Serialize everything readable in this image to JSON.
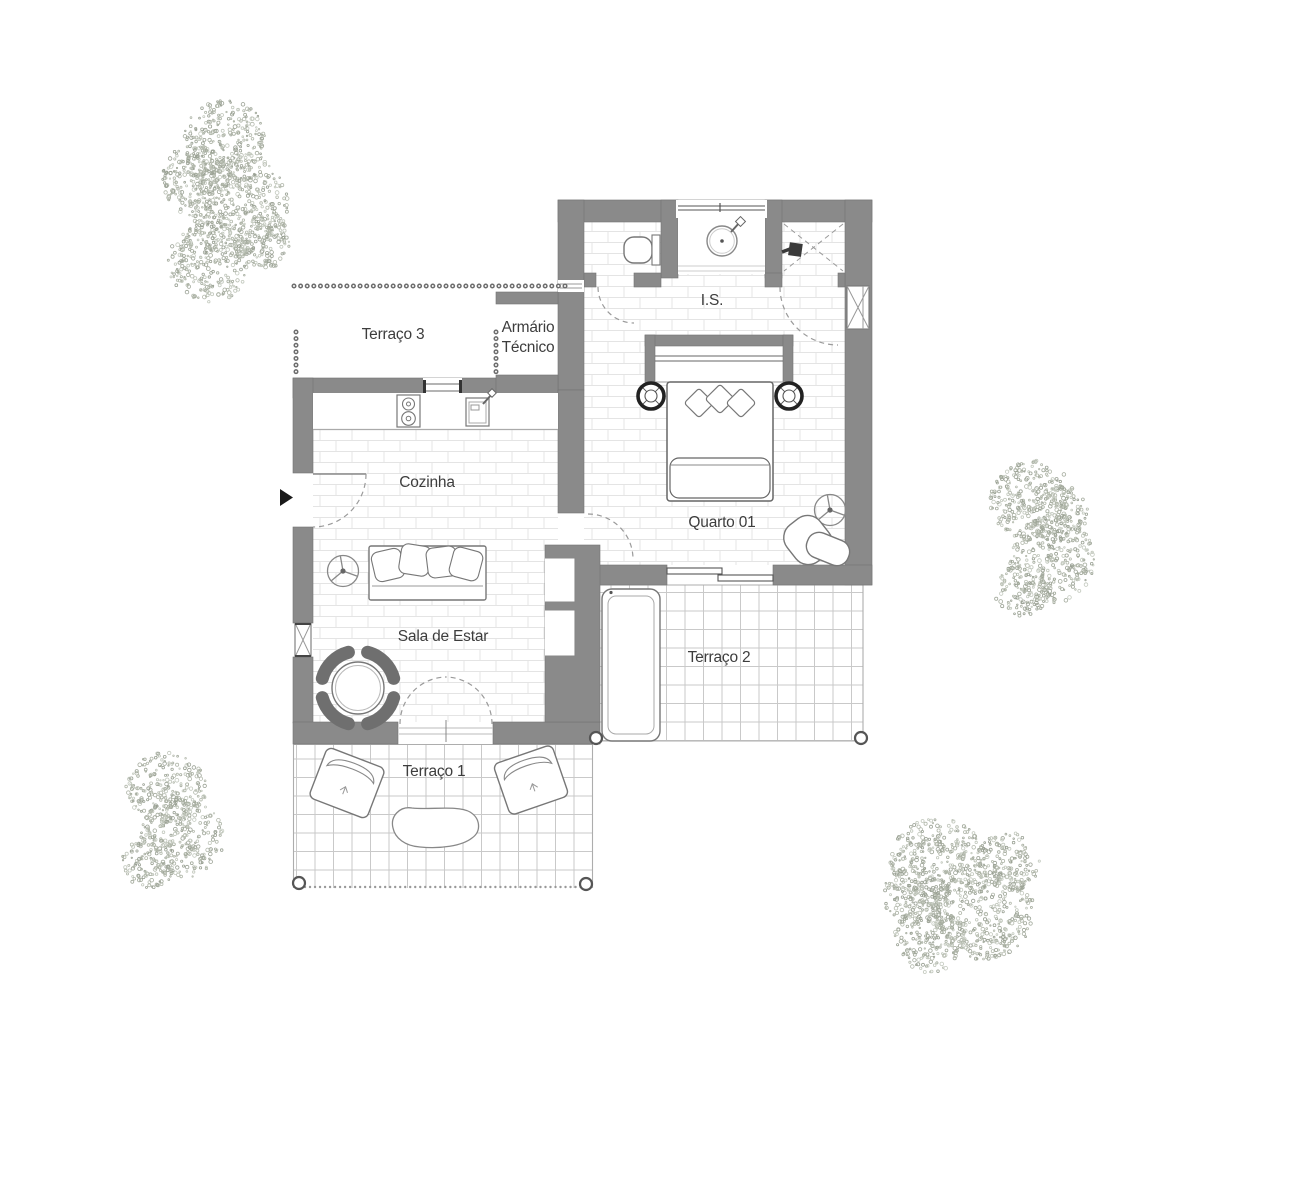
{
  "plan": {
    "type": "floor-plan",
    "rooms": {
      "terraco3": {
        "label": "Terraço 3"
      },
      "armario": {
        "line1": "Armário",
        "line2": "Técnico"
      },
      "is": {
        "label": "I.S."
      },
      "cozinha": {
        "label": "Cozinha"
      },
      "quarto01": {
        "label": "Quarto 01"
      },
      "sala": {
        "label": "Sala de Estar"
      },
      "terraco2": {
        "label": "Terraço 2"
      },
      "terraco1": {
        "label": "Terraço 1"
      }
    },
    "colors": {
      "wall": "#8a8a8a",
      "furniture_line": "#777777",
      "dark_furniture": "#6f6f6f",
      "label_text": "#3d3d3d",
      "brick_line": "#e4e4e4",
      "grid_line": "#c9c9c9",
      "tree_speckle": "#adb4a7",
      "background": "#ffffff"
    }
  }
}
